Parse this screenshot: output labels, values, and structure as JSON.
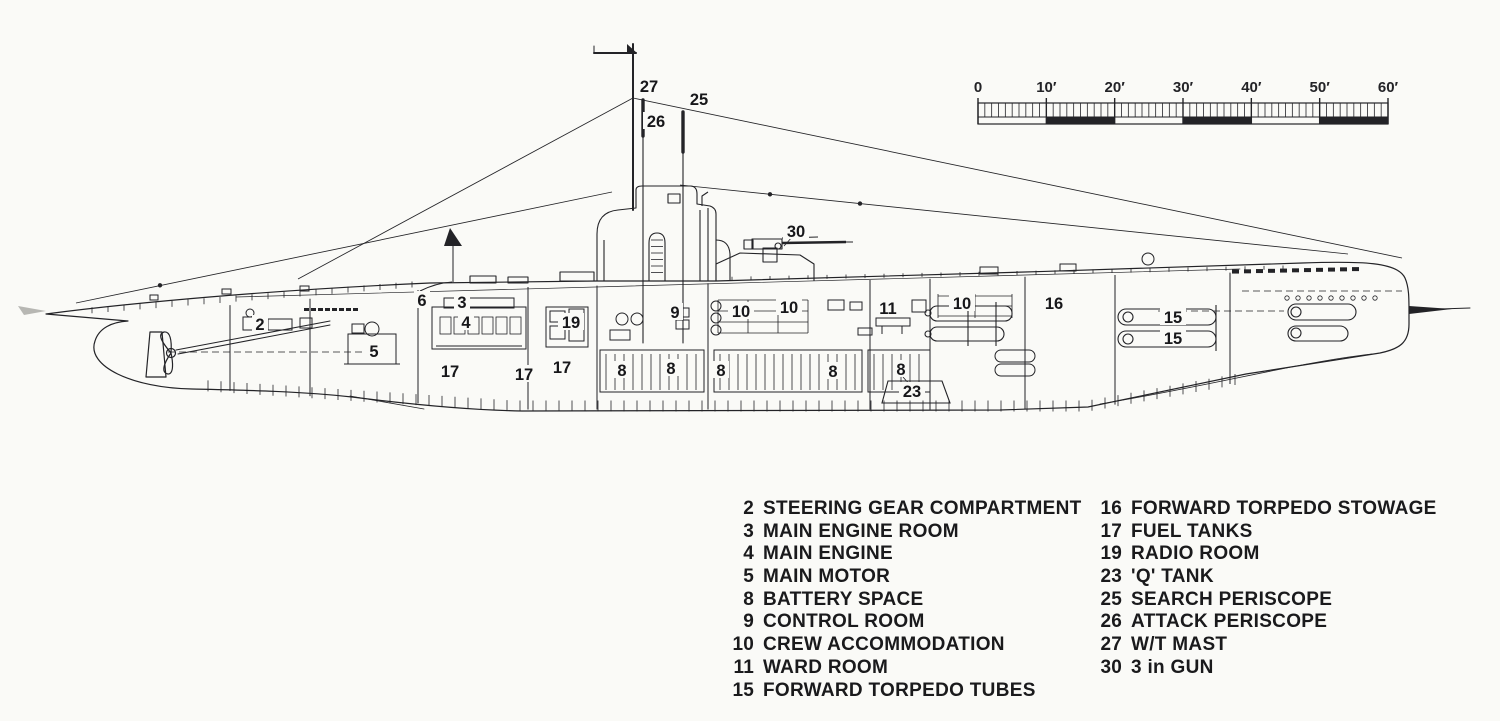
{
  "page": {
    "kind": "submarine cutaway side-elevation technical drawing",
    "paper_color": "#fafaf7",
    "ink_color": "#232327"
  },
  "scale_bar": {
    "unit": "feet",
    "labels": [
      "0",
      "10′",
      "20′",
      "30′",
      "40′",
      "50′",
      "60′"
    ],
    "major_values": [
      0,
      10,
      20,
      30,
      40,
      50,
      60
    ],
    "minor_per_major": 10,
    "max": 60
  },
  "diagram": {
    "callouts": [
      {
        "n": "27",
        "x": 649,
        "y": 86
      },
      {
        "n": "25",
        "x": 699,
        "y": 99
      },
      {
        "n": "26",
        "x": 656,
        "y": 121
      },
      {
        "n": "30",
        "x": 796,
        "y": 231
      },
      {
        "n": "2",
        "x": 260,
        "y": 324
      },
      {
        "n": "6",
        "x": 422,
        "y": 300
      },
      {
        "n": "3",
        "x": 462,
        "y": 302
      },
      {
        "n": "4",
        "x": 466,
        "y": 322
      },
      {
        "n": "5",
        "x": 374,
        "y": 351
      },
      {
        "n": "19",
        "x": 571,
        "y": 322
      },
      {
        "n": "9",
        "x": 675,
        "y": 312
      },
      {
        "n": "10",
        "x": 741,
        "y": 311
      },
      {
        "n": "10",
        "x": 789,
        "y": 307
      },
      {
        "n": "11",
        "x": 888,
        "y": 308
      },
      {
        "n": "10",
        "x": 962,
        "y": 303
      },
      {
        "n": "16",
        "x": 1054,
        "y": 303
      },
      {
        "n": "15",
        "x": 1173,
        "y": 317
      },
      {
        "n": "15",
        "x": 1173,
        "y": 338
      },
      {
        "n": "17",
        "x": 450,
        "y": 371
      },
      {
        "n": "17",
        "x": 524,
        "y": 374
      },
      {
        "n": "17",
        "x": 562,
        "y": 367
      },
      {
        "n": "8",
        "x": 622,
        "y": 370
      },
      {
        "n": "8",
        "x": 671,
        "y": 368
      },
      {
        "n": "8",
        "x": 721,
        "y": 370
      },
      {
        "n": "8",
        "x": 833,
        "y": 371
      },
      {
        "n": "8",
        "x": 901,
        "y": 369
      },
      {
        "n": "23",
        "x": 912,
        "y": 391
      }
    ]
  },
  "legend": {
    "columns": [
      {
        "items": [
          {
            "n": "2",
            "label": "STEERING GEAR COMPARTMENT"
          },
          {
            "n": "3",
            "label": "MAIN ENGINE ROOM"
          },
          {
            "n": "4",
            "label": "MAIN ENGINE"
          },
          {
            "n": "5",
            "label": "MAIN MOTOR"
          },
          {
            "n": "8",
            "label": "BATTERY SPACE"
          },
          {
            "n": "9",
            "label": "CONTROL ROOM"
          },
          {
            "n": "10",
            "label": "CREW ACCOMMODATION"
          },
          {
            "n": "11",
            "label": "WARD ROOM"
          },
          {
            "n": "15",
            "label": "FORWARD TORPEDO TUBES"
          }
        ]
      },
      {
        "items": [
          {
            "n": "16",
            "label": "FORWARD TORPEDO STOWAGE"
          },
          {
            "n": "17",
            "label": "FUEL TANKS"
          },
          {
            "n": "19",
            "label": "RADIO ROOM"
          },
          {
            "n": "23",
            "label": "'Q' TANK"
          },
          {
            "n": "25",
            "label": "SEARCH PERISCOPE"
          },
          {
            "n": "26",
            "label": "ATTACK PERISCOPE"
          },
          {
            "n": "27",
            "label": "W/T MAST"
          },
          {
            "n": "30",
            "label": "3 in GUN"
          }
        ]
      }
    ]
  }
}
